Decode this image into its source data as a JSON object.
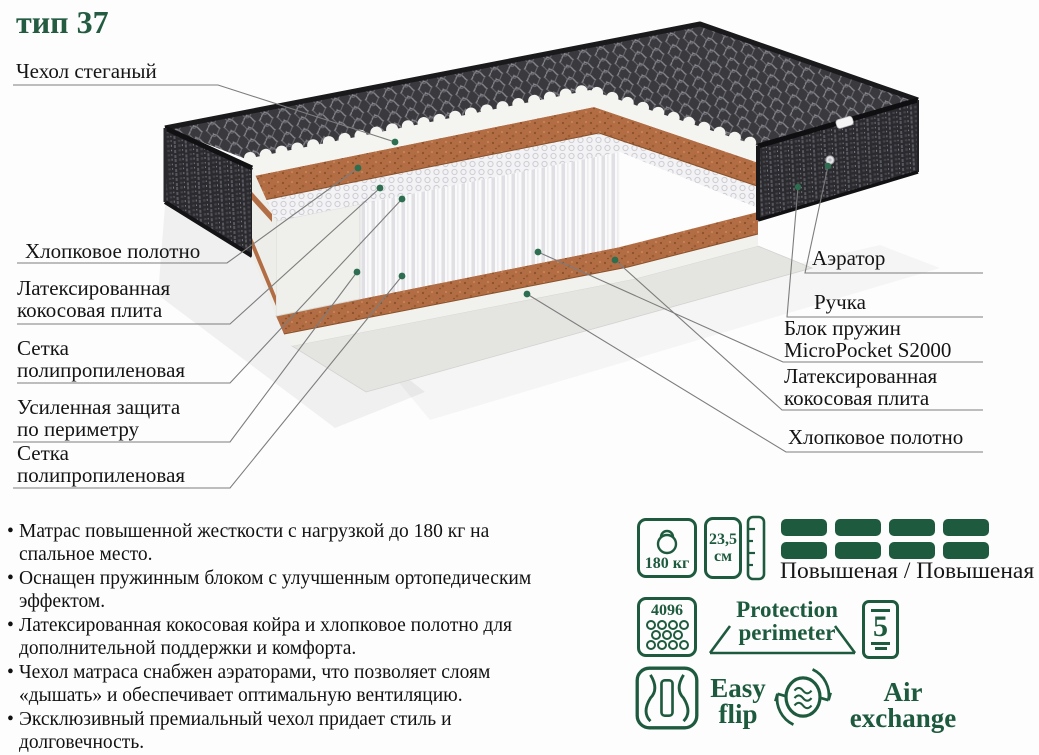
{
  "title": "тип 37",
  "colors": {
    "accent_green": "#1e5b3e",
    "title_green": "#235c40",
    "coir_brown": "#b26d44",
    "fabric_dark": "#3a3a3e"
  },
  "labels": {
    "left": [
      {
        "line1": "Чехол стеганый",
        "line2": ""
      },
      {
        "line1": "Хлопковое полотно",
        "line2": ""
      },
      {
        "line1": "Латексированная",
        "line2": "кокосовая плита"
      },
      {
        "line1": "Сетка",
        "line2": "полипропиленовая"
      },
      {
        "line1": "Усиленная защита",
        "line2": "по периметру"
      },
      {
        "line1": "Сетка",
        "line2": "полипропиленовая"
      }
    ],
    "right": [
      {
        "line1": "Аэратор",
        "line2": ""
      },
      {
        "line1": "Ручка",
        "line2": ""
      },
      {
        "line1": "Блок пружин",
        "line2": "MicroPocket S2000"
      },
      {
        "line1": "Латексированная",
        "line2": "кокосовая плита"
      },
      {
        "line1": "Хлопковое полотно",
        "line2": ""
      }
    ]
  },
  "features": [
    "Матрас повышенной жесткости с нагрузкой до 180 кг на спальное место.",
    "Оснащен пружинным блоком с улучшенным ортопедическим эффектом.",
    "Латексированная кокосовая койра и хлопковое полотно для дополнительной поддержки и комфорта.",
    "Чехол матраса снабжен аэраторами, что позволяет слоям «дышать» и обеспечивает оптимальную вентиляцию.",
    "Эксклюзивный премиальный чехол придает стиль и долговечность."
  ],
  "icons": {
    "weight": {
      "value": "180 кг"
    },
    "height": {
      "value": "23,5",
      "unit": "см"
    },
    "firmness": {
      "label": "Повышеная / Повышеная"
    },
    "springs_count": {
      "value": "4096"
    },
    "protection": {
      "line1": "Protection",
      "line2": "perimeter"
    },
    "zones": {
      "value": "5"
    },
    "easy_flip": {
      "line1": "Easy",
      "line2": "flip"
    },
    "air_exchange": {
      "line1": "Air",
      "line2": "exchange"
    }
  }
}
